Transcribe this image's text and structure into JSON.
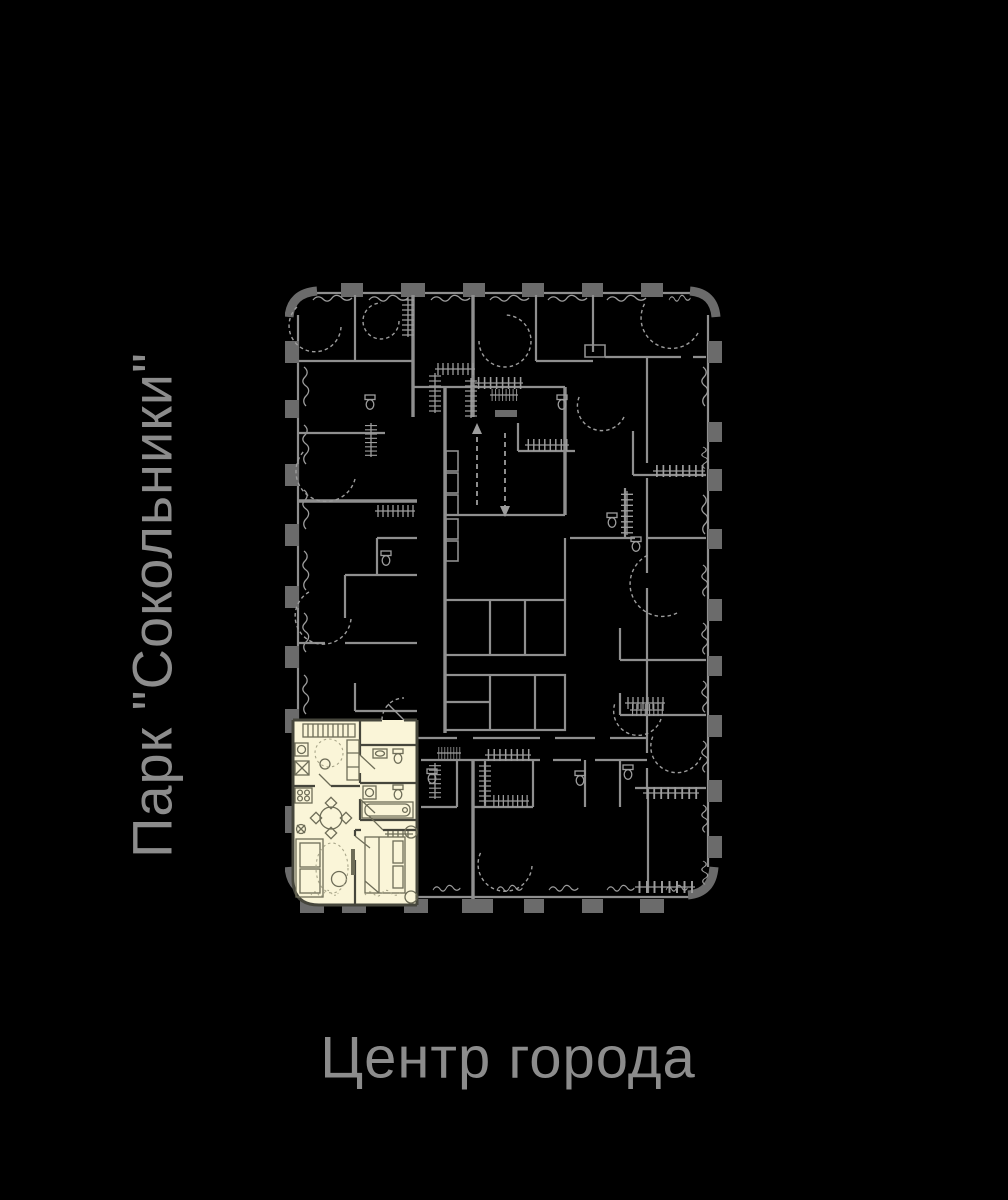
{
  "labels": {
    "left": "Парк \"Сокольники\"",
    "bottom": "Центр города",
    "color": "#8c8c8c"
  },
  "plan": {
    "background": "#000000",
    "wall_color": "#8f8f8f",
    "column_color": "#6b6b6b",
    "detail_color": "#9d9d9d",
    "selected_unit": {
      "fill": "#faf5d8",
      "wall_color": "#46463c",
      "furniture_color": "#6e6d58"
    }
  }
}
